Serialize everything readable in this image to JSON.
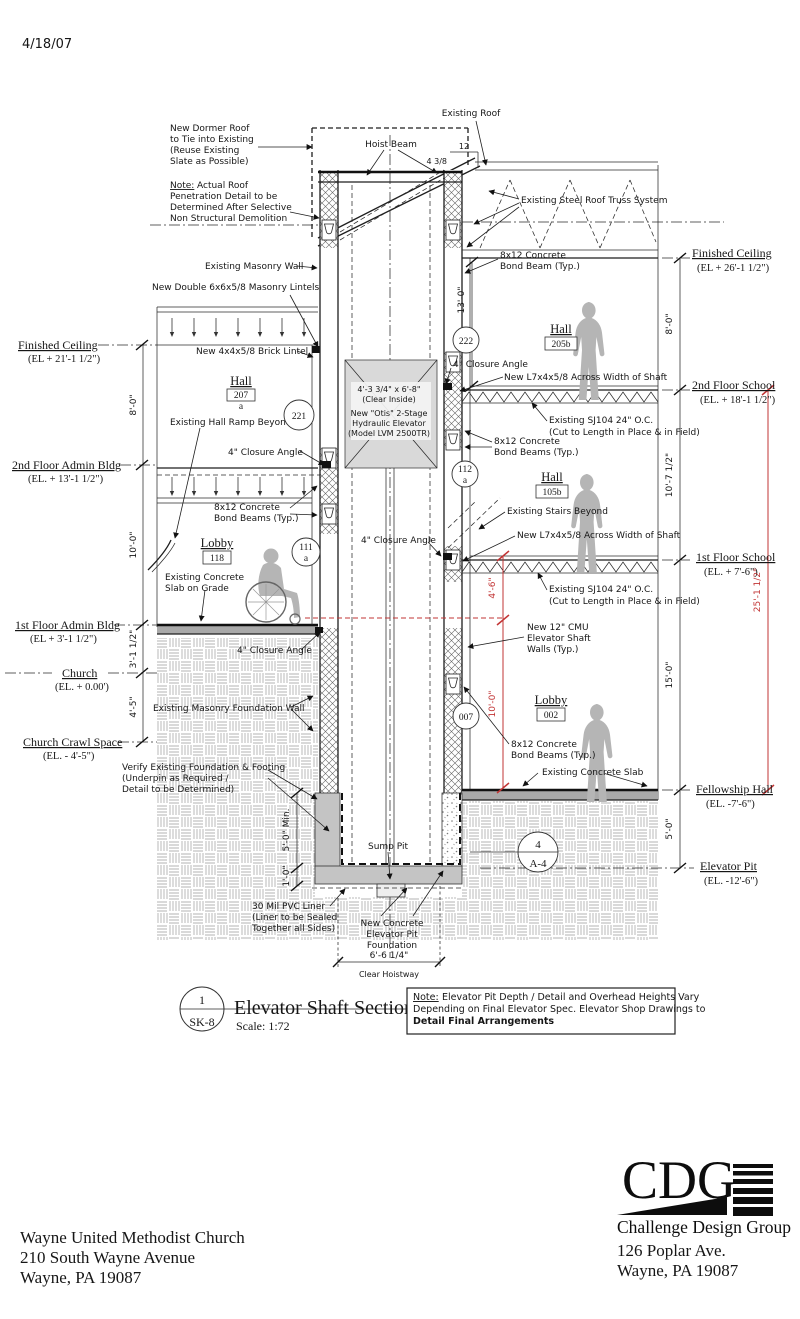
{
  "date": "4/18/07",
  "colors": {
    "red": "#c23535",
    "cab_gray": "#d9d9d9",
    "earth_line": "#9a9a9a",
    "silhouette": "#b5b5b5"
  },
  "roof": {
    "dormer_note": "New Dormer Roof\nto Tie into Existing\n(Reuse Existing\nSlate as Possible)",
    "pen_note_prefix": "Note:",
    "pen_note_line1": "Actual Roof",
    "pen_note_rest": "Penetration Detail to be\nDetermined After Selective\nNon Structural Demolition",
    "existing_roof": "Existing Roof",
    "hoist_beam": "Hoist Beam",
    "slope_rise": "4 3/8",
    "slope_run": "12",
    "truss": "Existing Steel Roof Truss System"
  },
  "walls": {
    "existing_masonry": "Existing Masonry Wall",
    "lintels": "New Double 6x6x5/8 Masonry Lintels",
    "brick_lintel": "New 4x4x5/8 Brick Lintel",
    "cmu": "New 12\" CMU\nElevator Shaft\nWalls (Typ.)",
    "foundation": "Existing Masonry Foundation Wall",
    "verify": "Verify Existing Foundation & Footing\n(Underpin as Required /\nDetail to be Determined)"
  },
  "beams": {
    "bond_beam": "8x12 Concrete\nBond Beam (Typ.)",
    "bond_beams": "8x12 Concrete\nBond Beams (Typ.)",
    "closure": "4\" Closure  Angle",
    "l7": "New L7x4x5/8 Across Width of Shaft",
    "sj104": "Existing SJ104 24\" O.C.\n(Cut to Length in Place & in Field)"
  },
  "elevator": {
    "cab_size": "4'-3 3/4\" x 6'-8\"",
    "cab_clear": "(Clear Inside)",
    "cab_model": "New \"Otis\" 2-Stage\nHydraulic Elevator\n(Model LVM 2500TR)",
    "sump": "Sump Pit",
    "pvc": "30 Mil PVC Liner\n(Liner to be Sealed\nTogether all Sides)",
    "pit_foundation": "New Concrete\nElevator Pit\nFoundation",
    "hoistway_dim": "6'-6 1/4\"",
    "hoistway_label": "Clear Hoistway"
  },
  "misc": {
    "hall_ramp": "Existing Hall Ramp Beyond",
    "stairs": "Existing Stairs Beyond",
    "slab_on_grade": "Existing Concrete\nSlab on Grade",
    "concrete_slab": "Existing Concrete Slab"
  },
  "rooms": [
    {
      "name": "Hall",
      "number": "207",
      "suffix": "a"
    },
    {
      "name": "Hall",
      "number": "205b"
    },
    {
      "name": "Hall",
      "number": "105b"
    },
    {
      "name": "Lobby",
      "number": "118"
    },
    {
      "name": "Lobby",
      "number": "002"
    }
  ],
  "tags": {
    "t221": "221",
    "t222": "222",
    "t112": "112",
    "t112s": "a",
    "t111": "111",
    "t111s": "a",
    "t007": "007"
  },
  "levels_left": [
    {
      "label": "Finished Ceiling",
      "el": "(EL + 21'-1 1/2\")"
    },
    {
      "label": "2nd Floor Admin Bldg",
      "el": "(EL. + 13'-1 1/2\")"
    },
    {
      "label": "1st Floor Admin Bldg",
      "el": "(EL + 3'-1 1/2\")"
    },
    {
      "label": "Church",
      "el": "(EL. + 0.00')"
    },
    {
      "label": "Church Crawl Space",
      "el": "(EL. - 4'-5\")"
    }
  ],
  "levels_right": [
    {
      "label": "Finished Ceiling",
      "el": "(EL + 26'-1 1/2\")"
    },
    {
      "label": "2nd Floor School",
      "el": "(EL. + 18'-1 1/2\")"
    },
    {
      "label": "1st Floor School",
      "el": "(EL. + 7'-6\")"
    },
    {
      "label": "Fellowship Hall",
      "el": "(EL. -7'-6\")"
    },
    {
      "label": "Elevator Pit",
      "el": "(EL. -12'-6\")"
    }
  ],
  "dims": {
    "left": [
      "8'-0\"",
      "10'-0\"",
      "3'-1 1/2\"",
      "4'-5\""
    ],
    "right": [
      "8'-0\"",
      "10'-7 1/2\"",
      "15'-0\"",
      "5'-0\""
    ],
    "shaft_top": "13'-0\"",
    "red_upper": "4'-6\"",
    "red_lower": "10'-0\"",
    "red_total": "25'-1 1/2\"",
    "pit_depth": "5'-0\" Min.",
    "pit_slab": "1'-0\""
  },
  "title_block": {
    "detail_no": "1",
    "sheet": "SK-8",
    "title": "Elevator Shaft Section A",
    "scale": "Scale: 1:72",
    "note_prefix": "Note:",
    "note_line1": "Elevator Pit Depth / Detail and Overhead  Heights Vary",
    "note_line2": "Depending on Final Elevator Spec. Elevator Shop Drawings to",
    "note_line3": "Detail Final Arrangements"
  },
  "pit_detail": {
    "num": "4",
    "sheet": "A-4"
  },
  "footer": {
    "client_name": "Wayne United Methodist Church",
    "client_addr1": "210 South Wayne Avenue",
    "client_addr2": "Wayne, PA 19087",
    "firm_initials": "CDG",
    "firm_name": "Challenge Design Group",
    "firm_addr1": "126 Poplar Ave.",
    "firm_addr2": "Wayne, PA 19087"
  }
}
